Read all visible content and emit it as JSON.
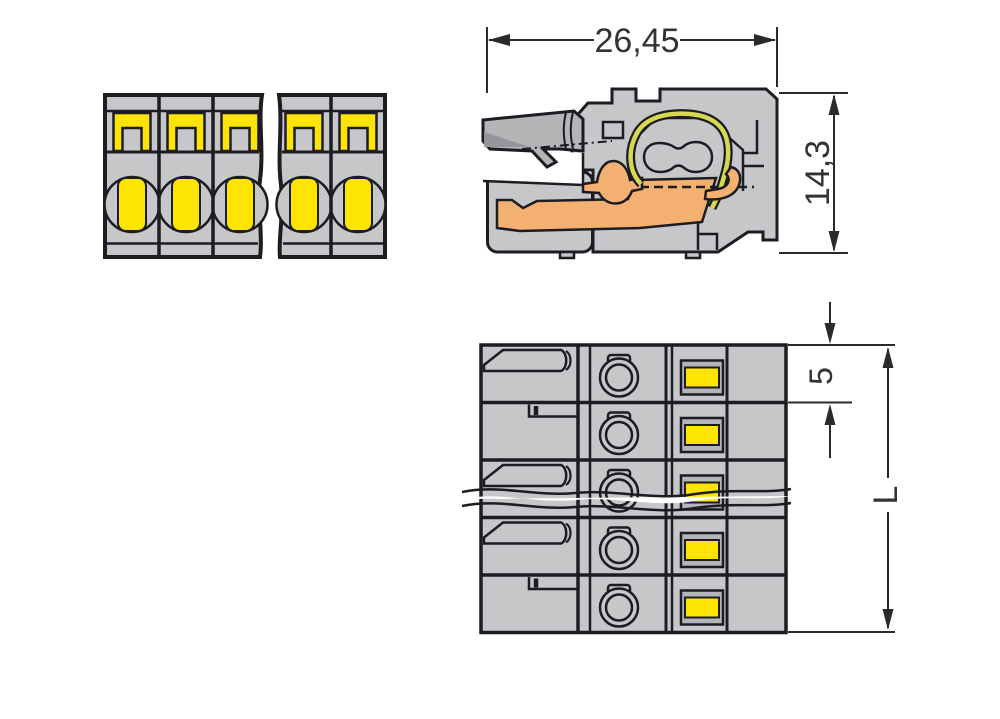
{
  "drawing": {
    "title": "connector-technical-drawing",
    "section_view": {
      "width_dim": "26,45",
      "height_dim": "14,3"
    },
    "top_view": {
      "pitch_dim": "5",
      "length_dim": "L",
      "rows_shown": 5
    },
    "front_view": {
      "positions_shown": 5
    }
  },
  "colors": {
    "body_gray": "#c6c7c9",
    "lever_gray": "#b4b5b7",
    "shadow_gray": "#94969a",
    "accent_yellow": "#fde403",
    "contact_orange": "#f4b071",
    "spring_green": "#d6d94e",
    "outline": "#1c1c22",
    "dim_line": "#2b2b2b",
    "dim_text": "#333333",
    "background": "#ffffff"
  }
}
